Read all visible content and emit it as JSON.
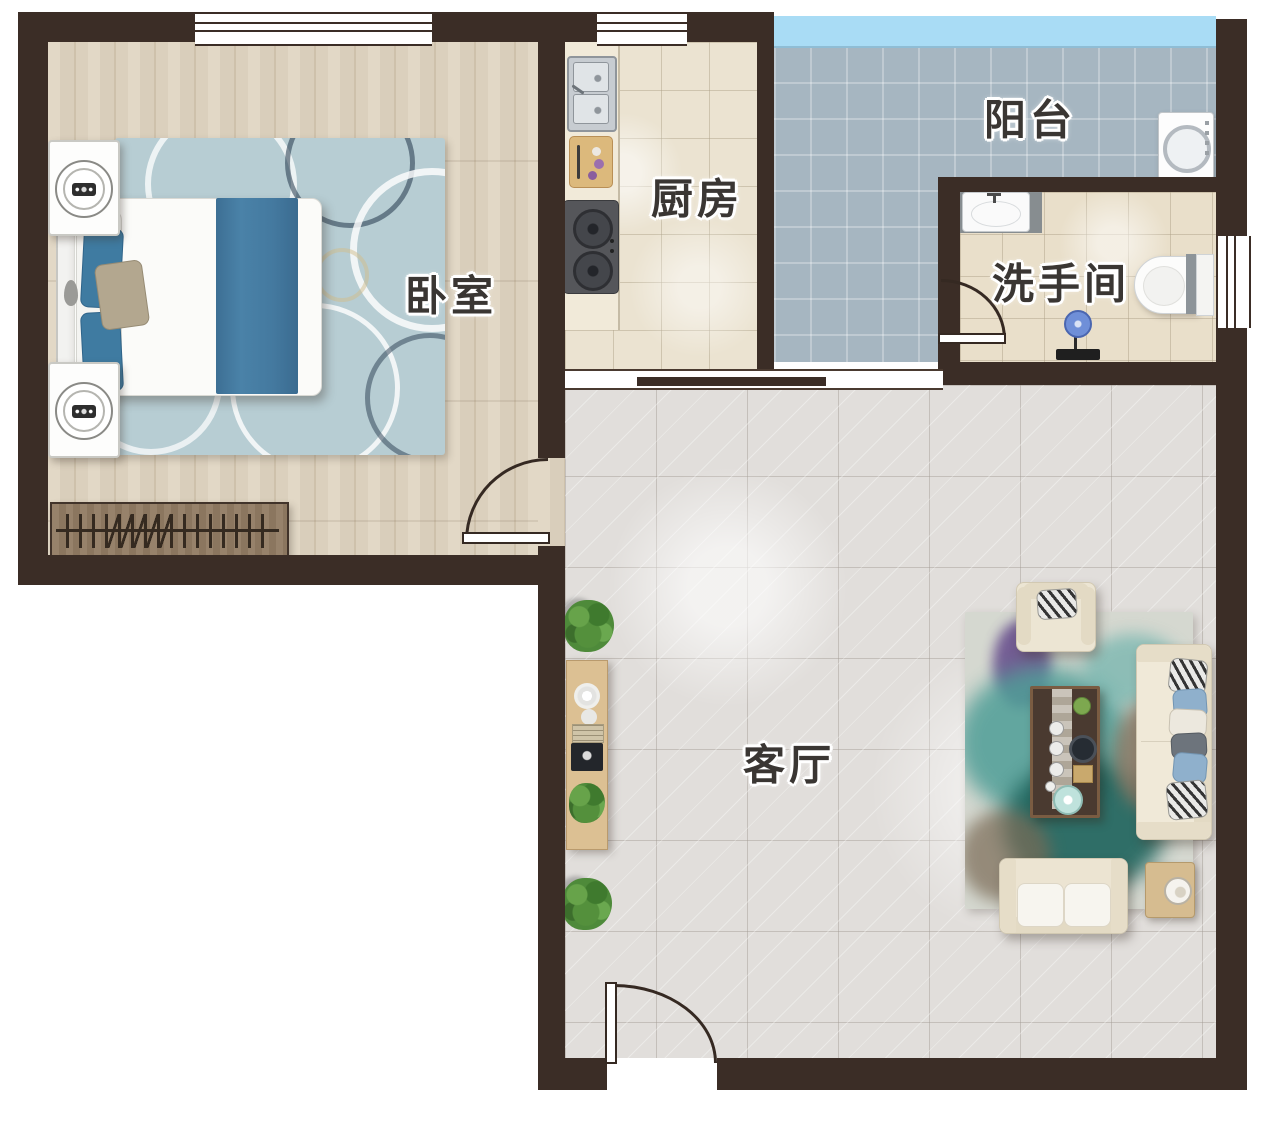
{
  "page": {
    "type": "apartment floor plan",
    "background": "#ffffff"
  },
  "rooms": {
    "bedroom": {
      "label": "卧室",
      "furniture": [
        "double-bed",
        "nightstand-with-lamp",
        "nightstand-with-lamp",
        "patterned-area-rug",
        "radiator-bench"
      ]
    },
    "kitchen": {
      "label": "厨房",
      "furniture": [
        "double-basin-sink",
        "cutting-board",
        "two-burner-gas-stove",
        "counter"
      ]
    },
    "balcony": {
      "label": "阳台",
      "furniture": [
        "washing-machine"
      ]
    },
    "bathroom": {
      "label": "洗手间",
      "furniture": [
        "vanity-sink",
        "toilet",
        "floor-mop-stand"
      ]
    },
    "living_room": {
      "label": "客厅",
      "furniture": [
        "tv-console",
        "potted-plant",
        "potted-plant",
        "abstract-area-rug",
        "armchair",
        "three-seat-sofa",
        "loveseat",
        "coffee-table-with-tea-set",
        "side-table"
      ]
    }
  },
  "colors": {
    "wall": "#3b2d26",
    "bedroom_floor": "#dcd1bd",
    "kitchen_floor": "#ebe3d1",
    "balcony_floor": "#a6b6c1",
    "balcony_glazing": "#a9dcf5",
    "bathroom_floor": "#e9dfca",
    "living_room_floor": "#e1dedb",
    "bed_accent_teal": "#44799f",
    "bedroom_rug_blue": "#b7cdd3",
    "living_rug_teal": "#4f9e97",
    "sofa_cream": "#ece4d2",
    "wood_furniture": "#d6bc90"
  }
}
